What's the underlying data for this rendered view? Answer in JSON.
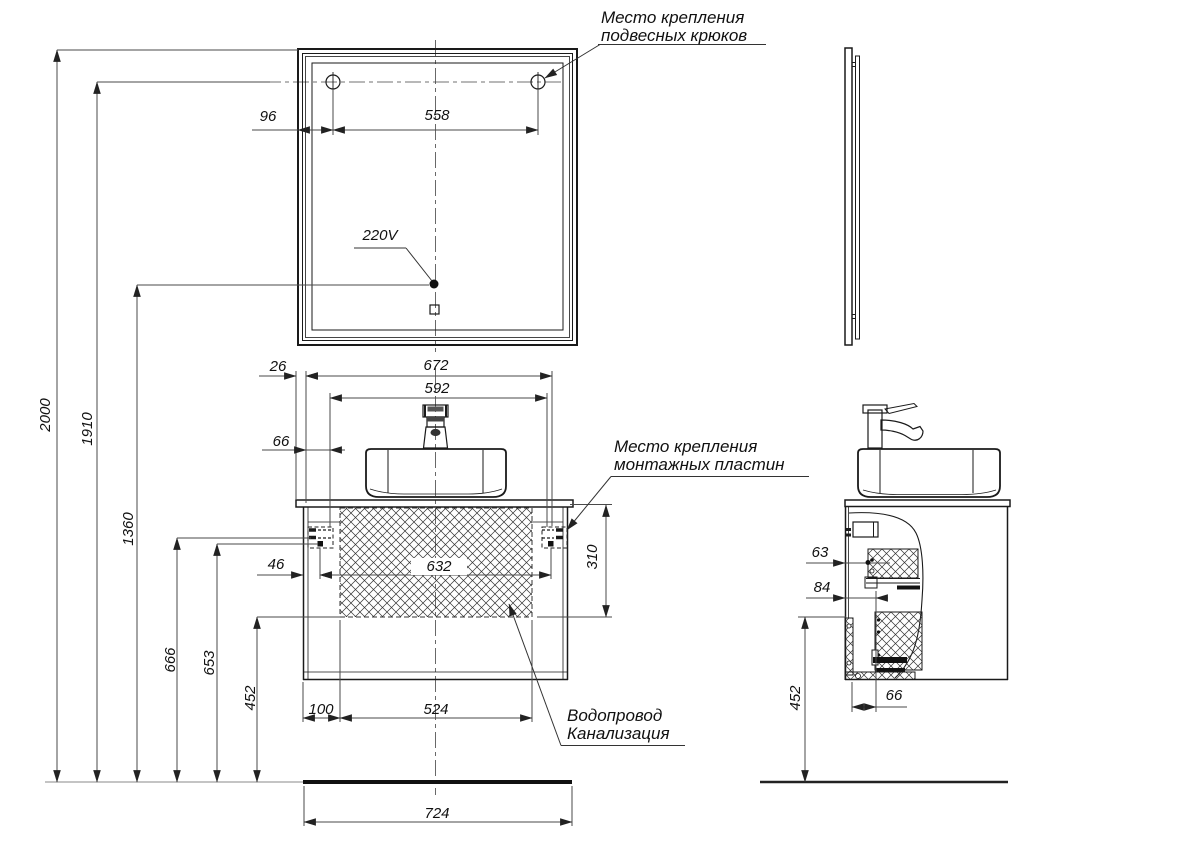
{
  "labels": {
    "hooks_line1": "Место крепления",
    "hooks_line2": "подвесных крюков",
    "plates_line1": "Место крепления",
    "plates_line2": "монтажных пластин",
    "utility_line1": "Водопровод",
    "utility_line2": "Канализация",
    "power": "220V"
  },
  "dimensions": {
    "mirror_hook_left_offset": "96",
    "mirror_hook_spacing": "558",
    "total_height": "2000",
    "hook_height": "1910",
    "socket_height": "1360",
    "plate_top_height": "666",
    "plate_screw_height": "653",
    "bottom_clearance_front": "452",
    "countertop_overhang": "26",
    "cabinet_mount_span": "672",
    "sink_mount_span": "592",
    "plate_front_offset": "66",
    "plate_edge_offset": "46",
    "plate_screw_spacing": "632",
    "cutout_height": "310",
    "cutout_left_offset": "100",
    "cutout_width": "524",
    "cabinet_width": "724",
    "side_plate_depth": "63",
    "side_rail_depth": "84",
    "side_bottom_rail_depth": "66",
    "bottom_clearance_side": "452"
  }
}
